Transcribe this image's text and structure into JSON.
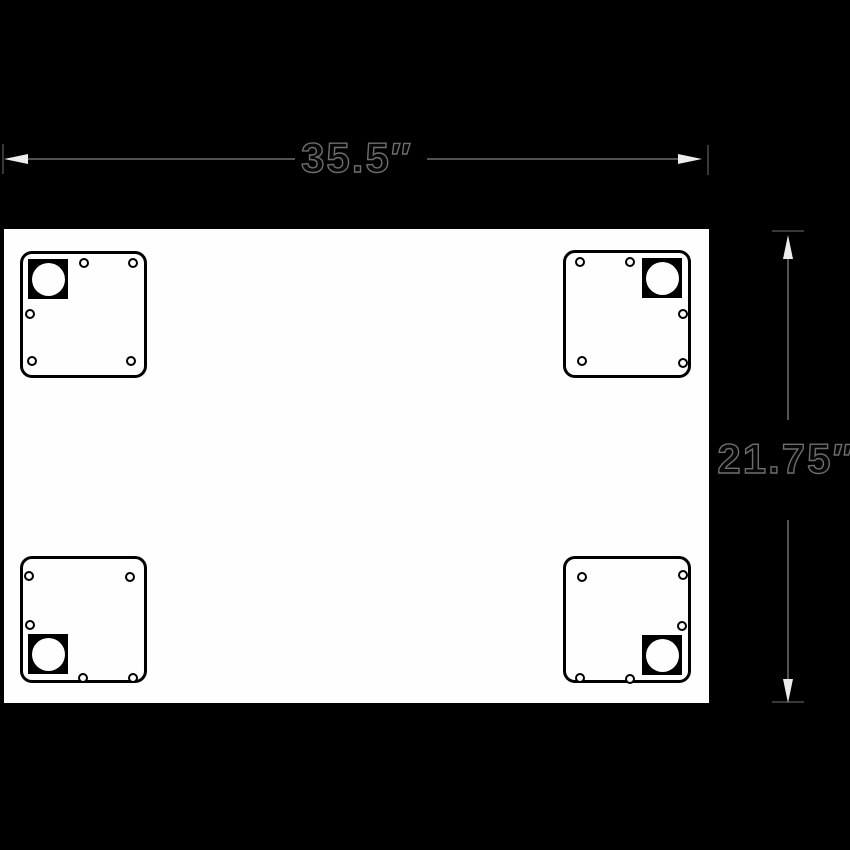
{
  "drawing_title": "table-top-mounting-diagram",
  "dimensions": {
    "width_label": "35.5″",
    "height_label": "21.75″"
  },
  "colors": {
    "background": "#000000",
    "panel_fill": "#fefefe",
    "stroke": "#000000",
    "dim_line": "#525252",
    "dim_tick": "#383838",
    "arrow_fill": "#ededed",
    "dim_text_fill": "#060606",
    "dim_text_outline": "#6e6e6e"
  },
  "icons": {
    "arrow_left": "left-arrowhead-icon",
    "arrow_right": "right-arrowhead-icon",
    "arrow_up": "up-arrowhead-icon",
    "arrow_down": "down-arrowhead-icon"
  },
  "brackets": [
    {
      "position": "top-left",
      "x": 20,
      "y": 251,
      "width": 127,
      "height": 127,
      "socket_corner": "top-left",
      "holes": [
        [
          61,
          9
        ],
        [
          110,
          9
        ],
        [
          7,
          60
        ],
        [
          9,
          107
        ],
        [
          108,
          107
        ]
      ]
    },
    {
      "position": "top-right",
      "x": 563,
      "y": 250,
      "width": 128,
      "height": 128,
      "socket_corner": "top-right",
      "holes": [
        [
          14,
          9
        ],
        [
          64,
          9
        ],
        [
          117,
          61
        ],
        [
          16,
          108
        ],
        [
          117,
          110
        ]
      ]
    },
    {
      "position": "bottom-left",
      "x": 20,
      "y": 556,
      "width": 127,
      "height": 127,
      "socket_corner": "bottom-left",
      "holes": [
        [
          6,
          17
        ],
        [
          107,
          18
        ],
        [
          7,
          66
        ],
        [
          60,
          119
        ],
        [
          110,
          119
        ]
      ]
    },
    {
      "position": "bottom-right",
      "x": 563,
      "y": 556,
      "width": 128,
      "height": 127,
      "socket_corner": "bottom-right",
      "holes": [
        [
          16,
          18
        ],
        [
          117,
          16
        ],
        [
          116,
          67
        ],
        [
          14,
          119
        ],
        [
          64,
          120
        ]
      ]
    }
  ]
}
